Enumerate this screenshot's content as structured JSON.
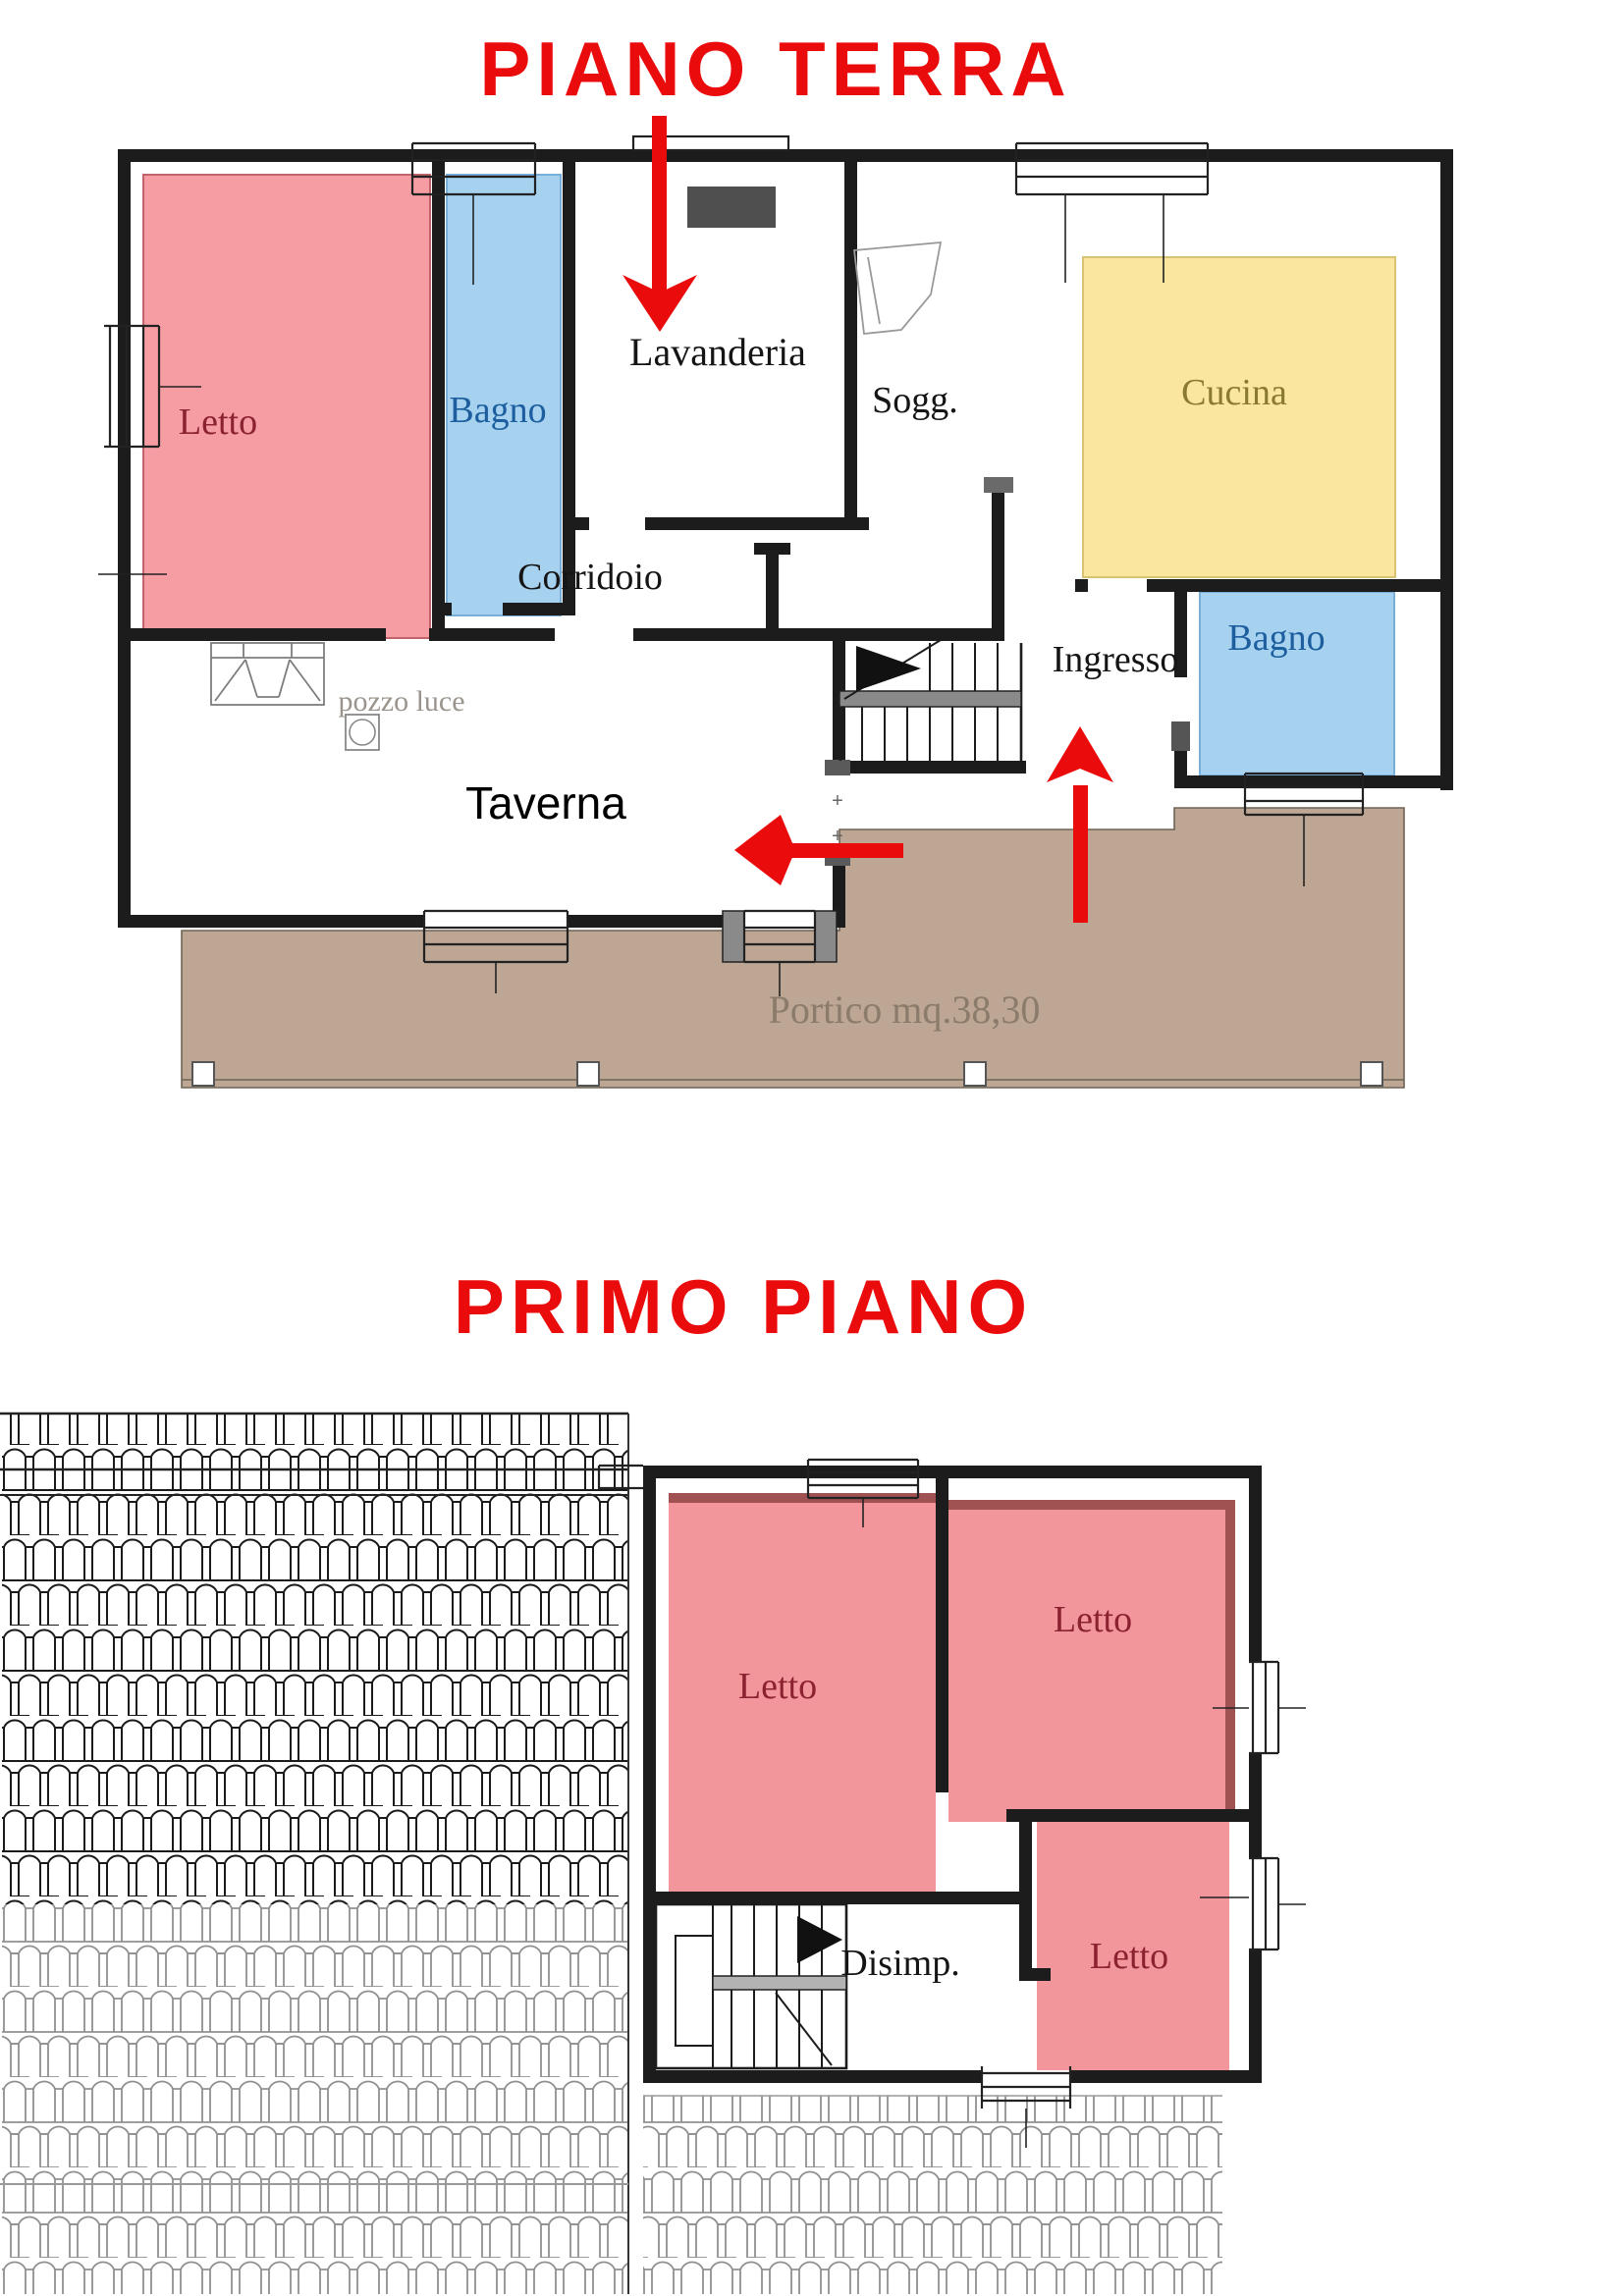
{
  "ground_floor": {
    "title": "PIANO TERRA",
    "rooms": {
      "letto": "Letto",
      "bagno": "Bagno",
      "lavanderia": "Lavanderia",
      "soggiorno": "Sogg.",
      "cucina": "Cucina",
      "corridoio": "Corridoio",
      "ingresso": "Ingresso",
      "bagno2": "Bagno",
      "taverna": "Taverna",
      "pozzo_luce": "pozzo luce",
      "portico": "Portico mq.38,30"
    },
    "door_mark": "+"
  },
  "first_floor": {
    "title": "PRIMO PIANO",
    "rooms": {
      "letto_left": "Letto",
      "letto_top_right": "Letto",
      "letto_bottom_right": "Letto",
      "disimp": "Disimp."
    }
  },
  "colors": {
    "accent_red": "#EA0B0C",
    "room_pink": "#F59DA2",
    "room_pink_first": "#F2969C",
    "room_pink_shade": "#A05252",
    "room_blue": "#A6D2F0",
    "room_yellow": "#FAE69E",
    "portico_brown": "#BDA693",
    "wall": "#1C1C1C",
    "label_letto": "#8B2230",
    "label_bagno": "#1D5E9E",
    "label_cucina": "#8A7A30",
    "label_portico": "#8A7B6B",
    "label_pozzo": "#9A948C"
  }
}
